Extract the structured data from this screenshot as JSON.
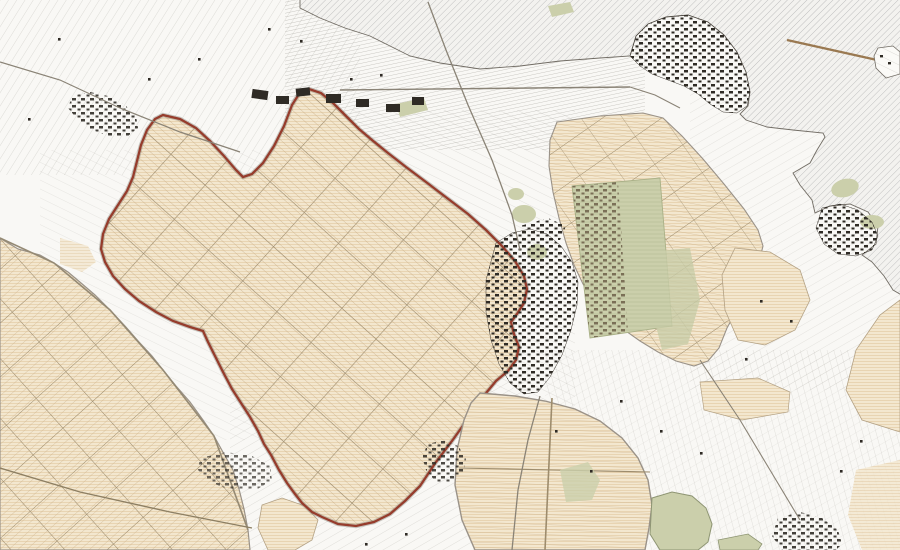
{
  "map": {
    "name": "polder-landscape-topographic-map",
    "kind": "cadastral-topographic-map",
    "description": "Historic-style cadastral map of a polder landscape: a large polder outlined in dark red at center-left, tan reclaimed polders with diagonal parcel grids, dense black built-up towns, olive-green park/orchard zones, fine strip parcels on white land, and diagonally hatched open water at the top right with a long dike leading to a small island.",
    "palette": {
      "background": "#f9f8f5",
      "white_land": "#fbfaf7",
      "water_hatch_line": "#bdbdbd",
      "water_base": "#f3f2ef",
      "parcel_line_gray": "#9b988f",
      "polder_tan": "#f3e7cf",
      "polder_ruling": "#e6d0ab",
      "polder_strip_line": "#c9ae87",
      "polder_road": "#9d8c6d",
      "boundary_red": "#963c2c",
      "boundary_casing": "#7d786d",
      "green_area": "#cbcfab",
      "green_dark": "#a9b087",
      "urban_dark": "#2f2b25",
      "urban_brown": "#6d5f49",
      "road_gray": "#8a8376",
      "dike_brown": "#9a7951",
      "coastline": "#716c64"
    },
    "regions": [
      {
        "id": "water-area",
        "label": "hatched open water",
        "kind": "water"
      },
      {
        "id": "highlighted-polder",
        "label": "red-outlined polder",
        "kind": "polder",
        "outline": "#963c2c"
      },
      {
        "id": "west-polder",
        "label": "western tan polder",
        "kind": "polder"
      },
      {
        "id": "east-polder",
        "label": "eastern tan polder with green development zone",
        "kind": "polder"
      },
      {
        "id": "south-polder",
        "label": "southern oval tan polder",
        "kind": "polder"
      },
      {
        "id": "central-town",
        "label": "dense town at center",
        "kind": "urban"
      },
      {
        "id": "coastal-town-north",
        "label": "coastal town on northern shore",
        "kind": "urban"
      },
      {
        "id": "coastal-town-east",
        "label": "harbour town on eastern shore",
        "kind": "urban"
      },
      {
        "id": "northwest-town",
        "label": "small town top-left",
        "kind": "urban"
      },
      {
        "id": "island-with-dike",
        "label": "small island reached by long dike",
        "kind": "land"
      }
    ]
  }
}
